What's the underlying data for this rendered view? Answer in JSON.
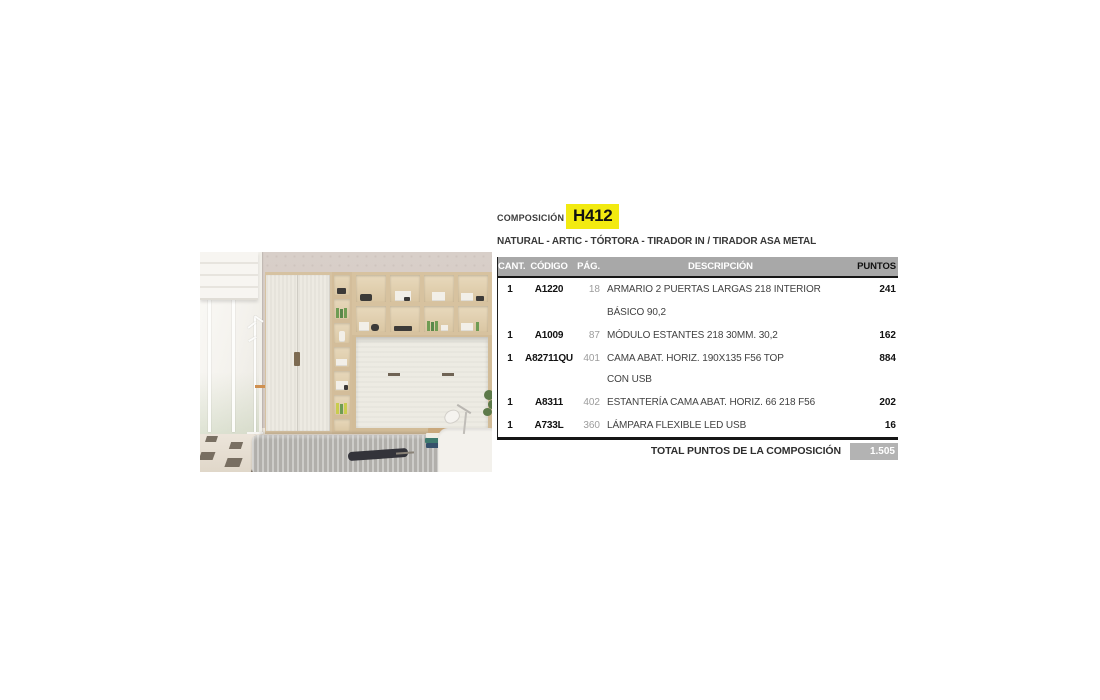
{
  "header": {
    "composition_label": "COMPOSICIÓN",
    "code": "H412",
    "finishes": "NATURAL - ARTIC - TÓRTORA - TIRADOR IN / TIRADOR ASA METAL"
  },
  "table": {
    "headers": {
      "cant": "CANT.",
      "codigo": "CÓDIGO",
      "pag": "PÁG.",
      "descripcion": "DESCRIPCIÓN",
      "puntos": "PUNTOS"
    },
    "rows": [
      {
        "cant": "1",
        "codigo": "A1220",
        "pag": "18",
        "descripcion": "ARMARIO 2 PUERTAS LARGAS 218 INTERIOR BÁSICO 90,2",
        "puntos": "241"
      },
      {
        "cant": "1",
        "codigo": "A1009",
        "pag": "87",
        "descripcion": "MÓDULO ESTANTES 218 30MM. 30,2",
        "puntos": "162"
      },
      {
        "cant": "1",
        "codigo": "A82711QU",
        "pag": "401",
        "descripcion": "CAMA ABAT. HORIZ. 190X135 F56 TOP",
        "descripcion2": "CON USB",
        "puntos": "884"
      },
      {
        "cant": "1",
        "codigo": "A8311",
        "pag": "402",
        "descripcion": "ESTANTERÍA CAMA ABAT. HORIZ. 66 218 F56",
        "puntos": "202"
      },
      {
        "cant": "1",
        "codigo": "A733L",
        "pag": "360",
        "descripcion": "LÁMPARA FLEXIBLE LED USB",
        "puntos": "16"
      }
    ],
    "total_label": "TOTAL PUNTOS DE LA COMPOSICIÓN",
    "total_value": "1.505"
  },
  "colors": {
    "accent_yellow": "#f2ea10",
    "header_gray": "#a8a8a8",
    "total_box_gray": "#b3b3b3"
  }
}
